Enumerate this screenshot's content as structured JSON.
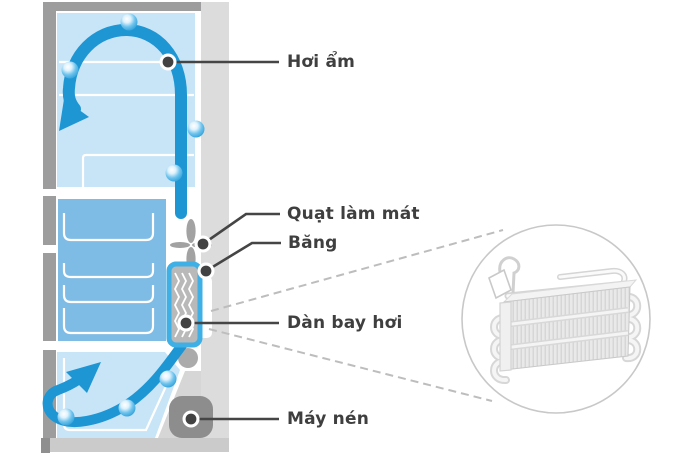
{
  "diagram": {
    "subject": "refrigerator-moisture-cooling-cycle",
    "callouts": [
      {
        "id": "moisture",
        "label": "Hơi ẩm"
      },
      {
        "id": "cooling-fan",
        "label": "Quạt làm mát"
      },
      {
        "id": "ice",
        "label": "Băng"
      },
      {
        "id": "evaporator",
        "label": "Dàn bay hơi"
      },
      {
        "id": "compressor",
        "label": "Máy nén"
      }
    ],
    "icons": [
      "water-droplet-icon",
      "airflow-arrow-icon",
      "cooling-fan-icon",
      "evaporator-coil-icon",
      "compressor-icon"
    ],
    "colors": {
      "compartment_light_blue": "#c8e4f7",
      "freezer_blue": "#7fbce5",
      "arrow_blue": "#1d96d3",
      "droplet_blue": "#3fade3",
      "evaporator_border_blue": "#3fb0e5",
      "frame_gray": "#9d9d9d",
      "side_panel_gray": "#dcdcdc",
      "machine_bay_gray": "#d6d6d6",
      "compressor_gray": "#8d8d8d",
      "callout_dark": "#454545",
      "dashed_line_gray": "#bdbdbd",
      "label_text": "#3f3f3f"
    }
  }
}
